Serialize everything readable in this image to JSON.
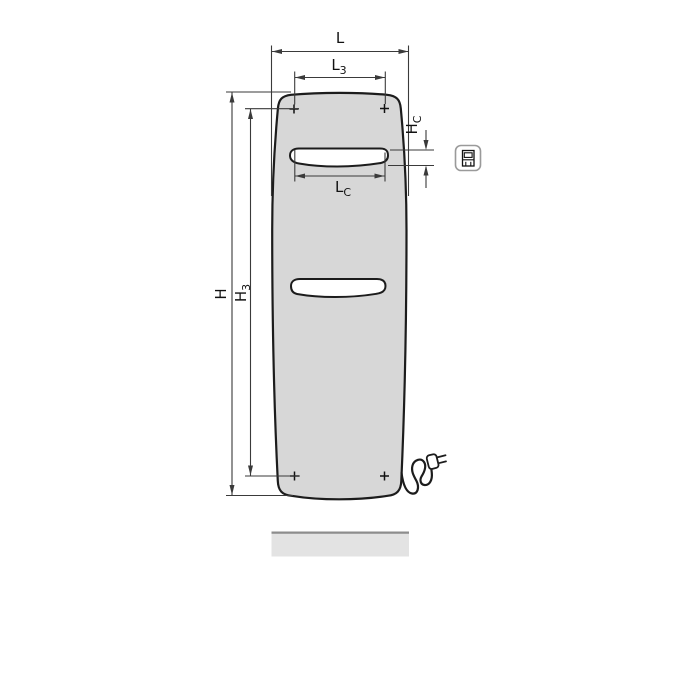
{
  "diagram": {
    "kind": "radiator-dimension-drawing",
    "dimensions": {
      "L": {
        "base": "L",
        "sub": ""
      },
      "L3": {
        "base": "L",
        "sub": "3"
      },
      "LC": {
        "base": "L",
        "sub": "C"
      },
      "H": {
        "base": "H",
        "sub": ""
      },
      "H3": {
        "base": "H",
        "sub": "3"
      },
      "HC": {
        "base": "H",
        "sub": "C"
      }
    },
    "icons": {
      "electric_connection": "electric-plug-pictogram-in-rounded-square"
    },
    "colors": {
      "background": "#ffffff",
      "panel_fill": "#d7d7d7",
      "outline": "#1c1c1c",
      "dimension_line": "#3a3a3a",
      "floor_fill": "#e3e3e3",
      "floor_edge": "#8d8d8d",
      "icon_border": "#9a9a9a"
    }
  }
}
